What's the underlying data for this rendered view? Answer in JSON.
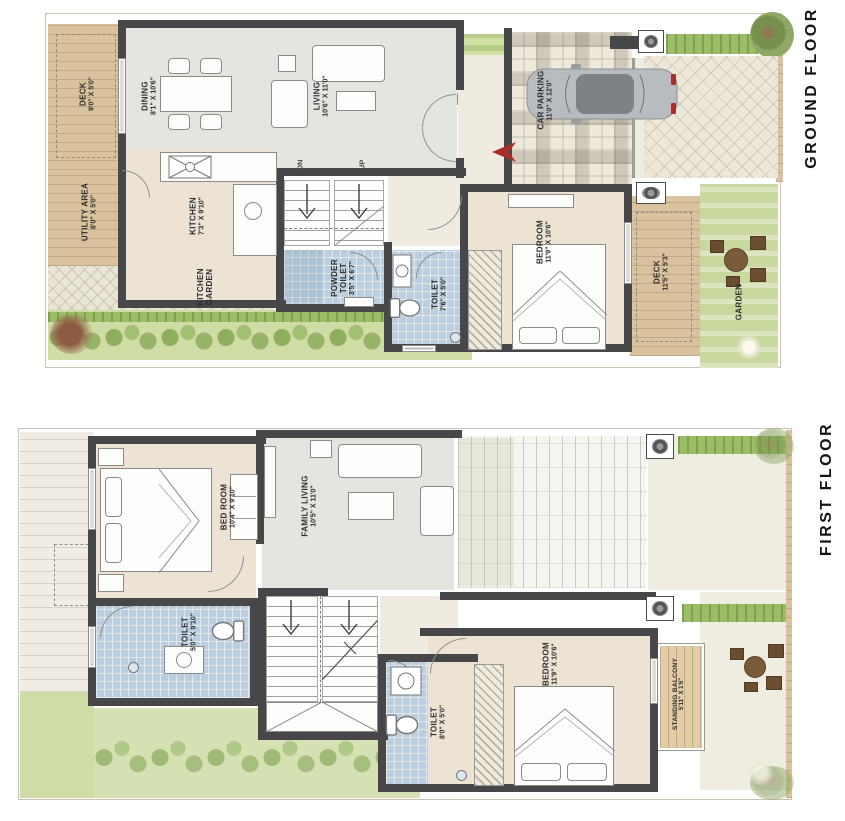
{
  "palette": {
    "wall": "#47474a",
    "tile": "#bccedd",
    "floor_gray": "#e4e5e1",
    "floor_cream": "#ece3d4",
    "paving": "#efe9dc",
    "garden": "#cfdca6",
    "hedge": "#9cbd66",
    "accent_red": "#a5302c",
    "title": "#151515"
  },
  "ground": {
    "title": "GROUND FLOOR",
    "stairs": {
      "dn": "DN",
      "up": "UP"
    },
    "rooms": [
      {
        "name": "DECK",
        "dims": "9'0\" X 5'0\""
      },
      {
        "name": "DINING",
        "dims": "8'1\" X 10'6\""
      },
      {
        "name": "LIVING",
        "dims": "10'6\" X 11'0\""
      },
      {
        "name": "CAR PARKING",
        "dims": "11'0\" X 12'0\""
      },
      {
        "name": "UTILITY AREA",
        "dims": "8'0\" X 5'0\""
      },
      {
        "name": "KITCHEN",
        "dims": "7'3\" X 9'10\""
      },
      {
        "name": "KITCHEN GARDEN"
      },
      {
        "name": "POWDER TOILET",
        "dims": "3'5\" X 6'7\""
      },
      {
        "name": "TOILET",
        "dims": "7'6\" X 5'0\""
      },
      {
        "name": "BEDROOM",
        "dims": "11'9\" X 10'6\""
      },
      {
        "name": "DECK",
        "dims": "11'5\" X 5'3\""
      },
      {
        "name": "GARDEN"
      }
    ]
  },
  "first": {
    "title": "FIRST FLOOR",
    "rooms": [
      {
        "name": "BED ROOM",
        "dims": "10'4\" X 9'10\""
      },
      {
        "name": "FAMILY LIVING",
        "dims": "10'5\" X 11'0\""
      },
      {
        "name": "TOILET",
        "dims": "5'0\" X 9'10\""
      },
      {
        "name": "TOILET",
        "dims": "8'0\" X 5'0\""
      },
      {
        "name": "BEDROOM",
        "dims": "11'9\" X 10'6\""
      },
      {
        "name": "STANDING BALCONY",
        "dims": "5'11\" X 1'6\""
      }
    ]
  }
}
